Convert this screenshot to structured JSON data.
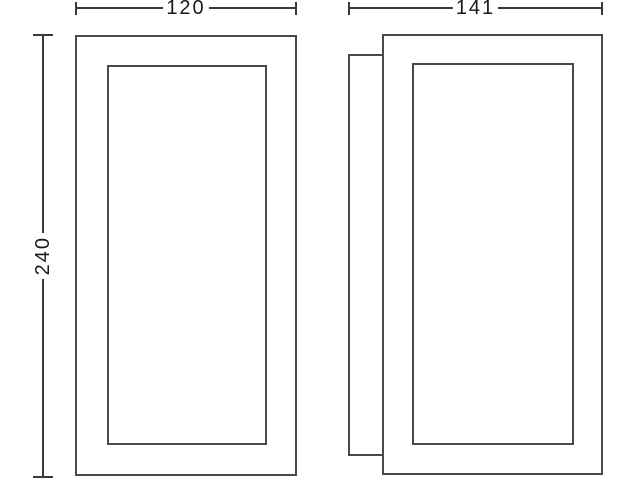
{
  "drawing": {
    "dimension_labels": {
      "front_width": "120",
      "side_depth": "141",
      "height": "240"
    },
    "colors": {
      "background": "#ffffff",
      "line": "#4a4a4a",
      "dimension": "#3a3a3a",
      "text": "#1a1a1a"
    }
  }
}
